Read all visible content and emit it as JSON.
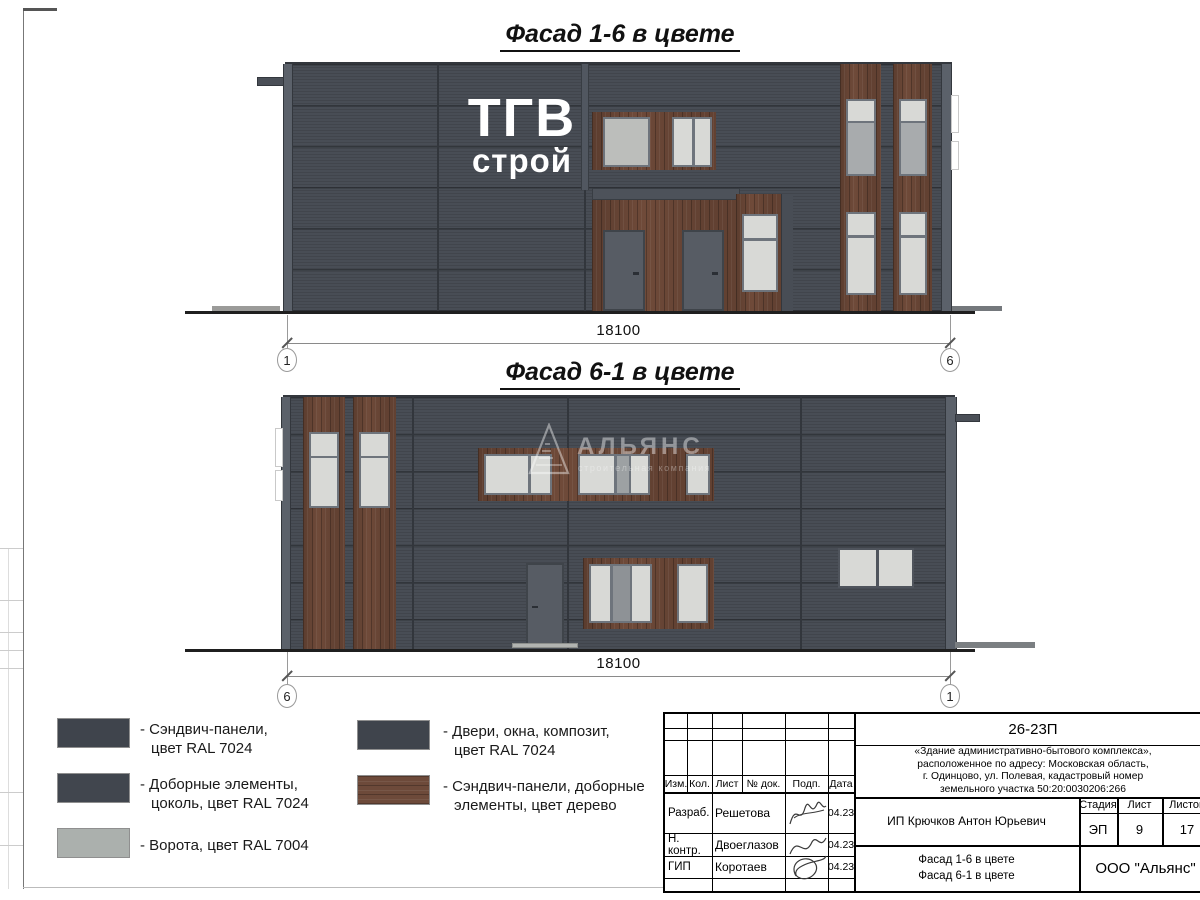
{
  "drawing": {
    "facade1": {
      "title": "Фасад 1-6 в цвете",
      "logo_top": "ТГВ",
      "logo_bottom": "строй",
      "dimension": "18100",
      "axis_left": "1",
      "axis_right": "6"
    },
    "facade2": {
      "title": "Фасад 6-1 в цвете",
      "dimension": "18100",
      "axis_left": "6",
      "axis_right": "1",
      "watermark_name": "АЛЬЯНС",
      "watermark_subtitle": "строительная компания"
    }
  },
  "legend": {
    "items": [
      {
        "color": "#3f444c",
        "line1": "- Сэндвич-панели,",
        "line2": "цвет RAL 7024"
      },
      {
        "color": "#41464e",
        "line1": "- Доборные элементы,",
        "line2": "цоколь, цвет RAL 7024"
      },
      {
        "color": "#abb0ad",
        "line1": "- Ворота, цвет RAL 7004",
        "line2": ""
      },
      {
        "color": "#3f444c",
        "line1": "- Двери, окна, композит,",
        "line2": "цвет RAL 7024"
      },
      {
        "color": "#6d4a3a",
        "line1": "- Сэндвич-панели, доборные",
        "line2": "элементы, цвет дерево"
      }
    ]
  },
  "titleblock": {
    "doc_number": "26-23П",
    "project_line1": "«Здание административно-бытового комплекса»,",
    "project_line2": "расположенное по адресу: Московская область,",
    "project_line3": "г. Одинцово, ул. Полевая, кадастровый номер",
    "project_line4": "земельного участка 50:20:0030206:266",
    "headers": {
      "izm": "Изм.",
      "kol": "Кол.",
      "list": "Лист",
      "ndok": "№ док.",
      "podp": "Подп.",
      "data": "Дата",
      "stage": "Стадия",
      "sheet": "Лист",
      "sheets": "Листов"
    },
    "rows": [
      {
        "role": "Разраб.",
        "name": "Решетова",
        "date": "04.23"
      },
      {
        "role": "Н. контр.",
        "name": "Двоеглазов",
        "date": "04.23"
      },
      {
        "role": "ГИП",
        "name": "Коротаев",
        "date": "04.23"
      }
    ],
    "client": "ИП Крючков Антон Юрьевич",
    "stage": "ЭП",
    "sheet_number": "9",
    "sheets_total": "17",
    "subject_line1": "Фасад 1-6 в цвете",
    "subject_line2": "Фасад 6-1 в цвете",
    "company": "ООО \"Альянс\""
  },
  "colors": {
    "panel": "#484d55",
    "panel_seam": "#32363c",
    "wood": "#6f4a39",
    "ral7024": "#3f444c",
    "ral7004": "#abb0ad",
    "window_pane": "#d8d9d6",
    "window_frame": "#6e747c",
    "door": "#575c64"
  }
}
